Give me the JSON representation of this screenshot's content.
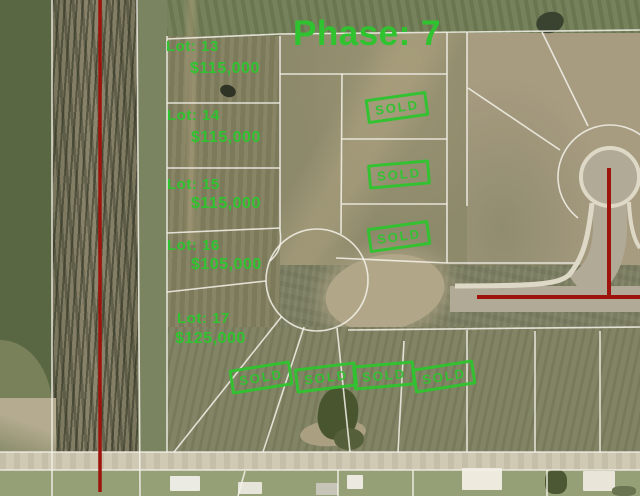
{
  "title": "Phase: 7",
  "lots": [
    {
      "name": "Lot: 13",
      "price": "$115,000"
    },
    {
      "name": "Lot: 14",
      "price": "$115,000"
    },
    {
      "name": "Lot: 15",
      "price": "$115,000"
    },
    {
      "name": "Lot: 16",
      "price": "$105,000"
    },
    {
      "name": "Lot: 17",
      "price": "$125,000"
    }
  ],
  "stamps": [
    {
      "label": "SOLD"
    },
    {
      "label": "SOLD"
    },
    {
      "label": "SOLD"
    },
    {
      "label": "SOLD"
    },
    {
      "label": "SOLD"
    },
    {
      "label": "SOLD"
    },
    {
      "label": "SOLD"
    }
  ],
  "colors": {
    "annotation-green": "#2fc42f",
    "boundary-red": "#9e140c",
    "lot-line-white": "#f4f2ea"
  }
}
